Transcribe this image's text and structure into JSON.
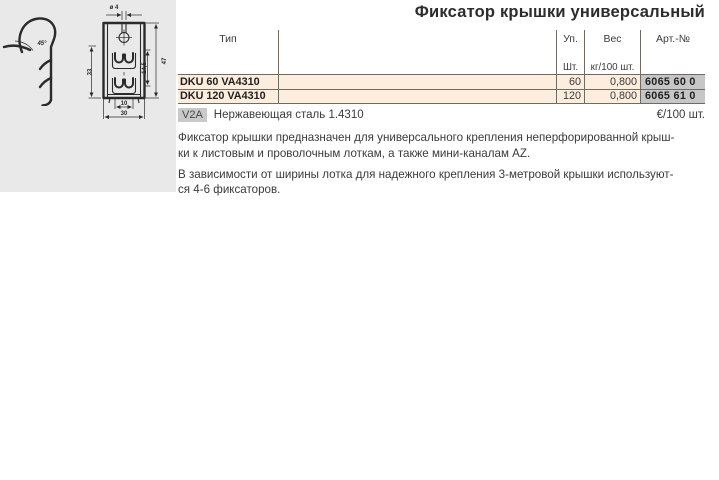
{
  "page": {
    "title": "Фиксатор крышки универсальный"
  },
  "drawing": {
    "dims": {
      "angle": "45°",
      "diameter": "ø 4",
      "height_side": "33",
      "inner_height": "14,5",
      "total_height": "47",
      "inner_width": "10",
      "total_width": "30"
    }
  },
  "table": {
    "columns": {
      "type": "Тип",
      "pack": "Уп.",
      "weight": "Вес",
      "art": "Арт.-№"
    },
    "subcolumns": {
      "pack": "Шт.",
      "weight": "кг/100 шт."
    },
    "rows": [
      {
        "type": "DKU 60 VA4310",
        "pack": "60",
        "weight": "0,800",
        "art": "6065 60 0"
      },
      {
        "type": "DKU 120 VA4310",
        "pack": "120",
        "weight": "0,800",
        "art": "6065 61 0"
      }
    ]
  },
  "material": {
    "badge": "V2A",
    "label": "Нержавеющая сталь 1.4310",
    "price_unit": "€/100 шт."
  },
  "description": {
    "para1_lines": [
      "Фиксатор крышки предназначен для универсального крепления неперфорированной крыш-",
      "ки к листовым и проволочным лоткам, а также мини-каналам AZ."
    ],
    "para2_lines": [
      "В зависимости от ширины лотка для надежного крепления 3-метровой крышки используют-",
      "ся 4-6 фиксаторов."
    ]
  },
  "colors": {
    "row_bg": "#fceddd",
    "art_bg": "#c6c6c6",
    "badge_bg": "#c9c9c9",
    "drawing_bg": "#e9e9e9",
    "line": "#6f6a62",
    "text": "#3a3a3a"
  }
}
